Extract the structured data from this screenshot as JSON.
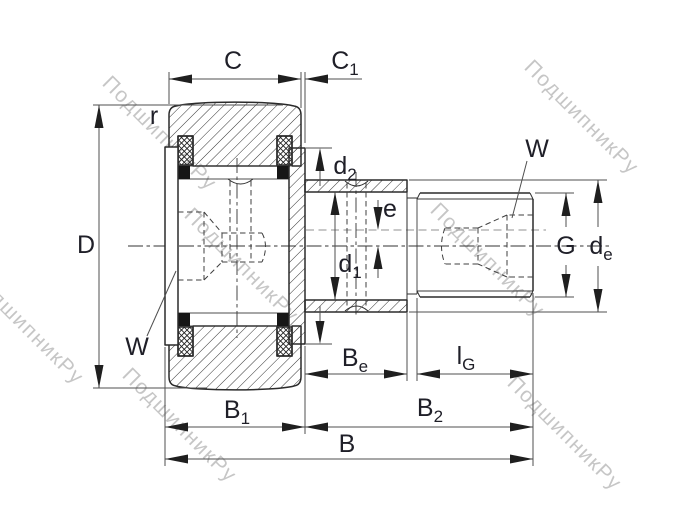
{
  "drawing": {
    "watermark_text": "ПодшипникРу",
    "labels": {
      "C": {
        "main": "C",
        "sub": ""
      },
      "C1": {
        "main": "C",
        "sub": "1"
      },
      "r": {
        "main": "r",
        "sub": ""
      },
      "D": {
        "main": "D",
        "sub": ""
      },
      "W_right": {
        "main": "W",
        "sub": ""
      },
      "W_left": {
        "main": "W",
        "sub": ""
      },
      "d2": {
        "main": "d",
        "sub": "2"
      },
      "e": {
        "main": "e",
        "sub": ""
      },
      "d1": {
        "main": "d",
        "sub": "1"
      },
      "G": {
        "main": "G",
        "sub": ""
      },
      "de": {
        "main": "d",
        "sub": "e"
      },
      "Be": {
        "main": "B",
        "sub": "e"
      },
      "lG": {
        "main": "l",
        "sub": "G"
      },
      "B1": {
        "main": "B",
        "sub": "1"
      },
      "B2": {
        "main": "B",
        "sub": "2"
      },
      "B": {
        "main": "B",
        "sub": ""
      }
    },
    "colors": {
      "background": "#ffffff",
      "outline": "#2b2b2b",
      "dimension": "#4f4f4f",
      "label": "#1f1f28",
      "watermark": "#8f8f8f",
      "eccentric_axis": "#a6a6a6"
    }
  }
}
